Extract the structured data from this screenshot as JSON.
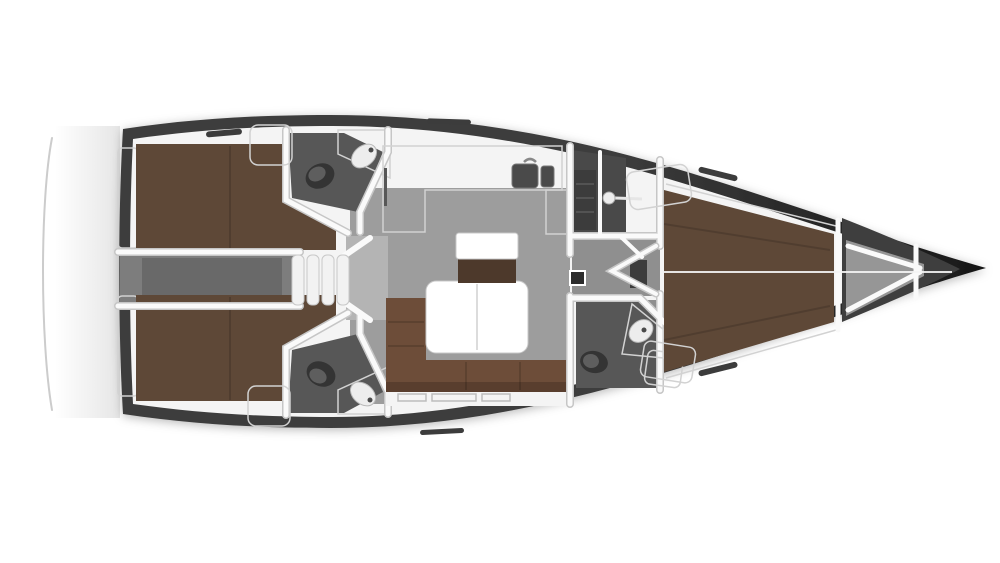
{
  "scene": {
    "subject": "sailing-yacht-interior-floorplan",
    "view": "top-down",
    "orientation": "bow-right-stern-left"
  },
  "palette": {
    "background": "#ffffff",
    "hull_dark": "#171717",
    "hull_mid": "#3e3e3e",
    "deck": "#f4f4f4",
    "deck_edge": "#d2d2d2",
    "wall": "#fafafa",
    "wall_edge": "#c6c6c6",
    "floor": "#9d9d9d",
    "floor_light": "#b4b4b4",
    "floor_mid": "#8f8f8f",
    "engine": "#7d7d7d",
    "engine_dark": "#696969",
    "head_floor": "#575757",
    "shower_floor": "#494949",
    "anchor": "#969696",
    "berth": "#5e4837",
    "berth_dark": "#4d392b",
    "sofa": "#6d4d39",
    "sofa_dark": "#593e2e",
    "table": "#ffffff",
    "fixture": "#ededed",
    "sink_basin": "#4a4a4a",
    "toilet": "#343434",
    "toilet_lid": "#5e5e5e",
    "panel": "#2c2c2c",
    "hatch": "#3c3c3c",
    "step": "#f2f2f2",
    "transom_line": "#cccccc"
  },
  "rooms": [
    {
      "id": "aft-cabin-port",
      "fixtures": [
        "double-berth",
        "shelf"
      ]
    },
    {
      "id": "aft-cabin-starboard",
      "fixtures": [
        "double-berth",
        "shelf"
      ]
    },
    {
      "id": "aft-head-port",
      "fixtures": [
        "toilet",
        "washbasin",
        "counter"
      ]
    },
    {
      "id": "aft-head-starboard",
      "fixtures": [
        "toilet",
        "washbasin",
        "counter"
      ]
    },
    {
      "id": "engine-compartment",
      "fixtures": []
    },
    {
      "id": "companionway",
      "fixtures": [
        "steps"
      ]
    },
    {
      "id": "galley",
      "fixtures": [
        "l-counter",
        "double-sink",
        "faucet",
        "oven"
      ]
    },
    {
      "id": "salon",
      "fixtures": [
        "l-sofa",
        "dining-table",
        "bench-seat",
        "side-table",
        "storage-slots"
      ]
    },
    {
      "id": "shower-room",
      "fixtures": [
        "shower-head",
        "slatted-bench"
      ]
    },
    {
      "id": "corridor",
      "fixtures": [
        "door-leaves",
        "electrical-panel",
        "step-hatch"
      ]
    },
    {
      "id": "forward-head",
      "fixtures": [
        "toilet",
        "washbasin",
        "counter",
        "cabinet"
      ]
    },
    {
      "id": "forward-cabin",
      "fixtures": [
        "v-berth",
        "locker-port",
        "locker-starboard"
      ]
    },
    {
      "id": "anchor-locker",
      "fixtures": [
        "bow-struts",
        "bulkhead"
      ]
    }
  ]
}
